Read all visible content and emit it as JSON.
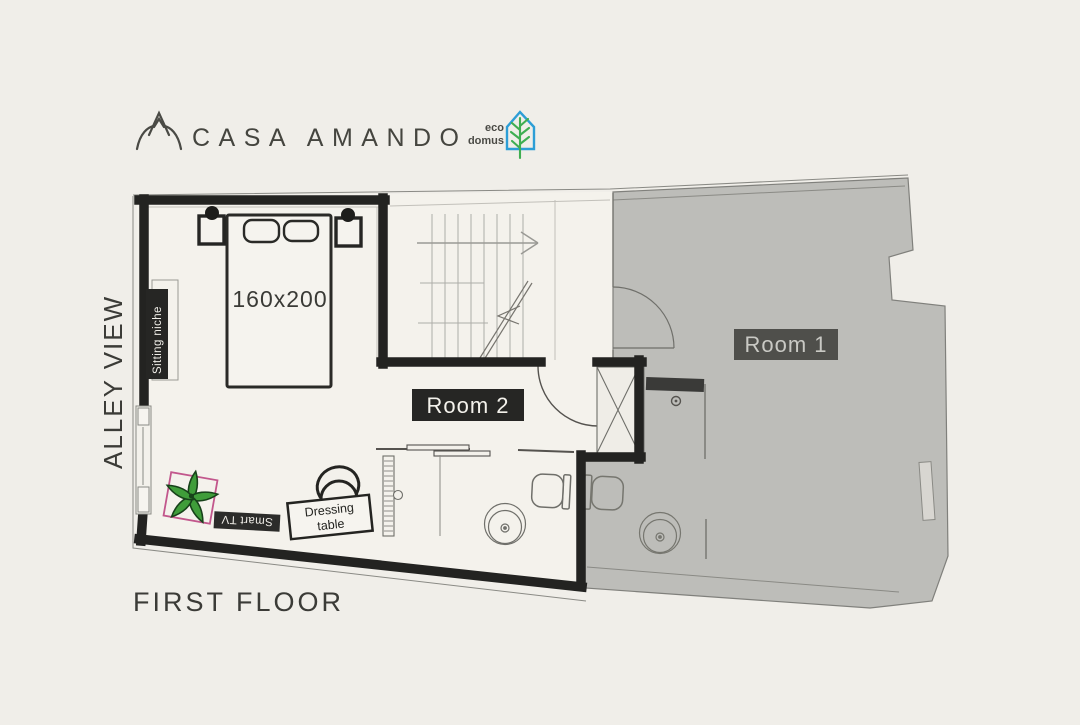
{
  "header": {
    "brand": "CASA AMANDO",
    "eco_word1": "eco",
    "eco_word2": "domus"
  },
  "plan": {
    "floor_label": "FIRST FLOOR",
    "side_label": "ALLEY VIEW",
    "room1_label": "Room 1",
    "room2_label": "Room 2",
    "bed_size": "160x200",
    "sitting_niche": "Sitting niche",
    "smart_tv": "Smart TV",
    "dressing_line1": "Dressing",
    "dressing_line2": "table"
  },
  "colors": {
    "background": "#f0eee9",
    "floor_white": "#f4f2ec",
    "room1_fill": "#bdbdb9",
    "wall_black": "#232321",
    "badge_dark": "#262624",
    "room1_label_bg": "#4f4f4b",
    "plant_green": "#3f9d3a",
    "pot_pink": "#c2578c",
    "eco_blue": "#2d9ed6",
    "eco_green": "#3fae52"
  }
}
